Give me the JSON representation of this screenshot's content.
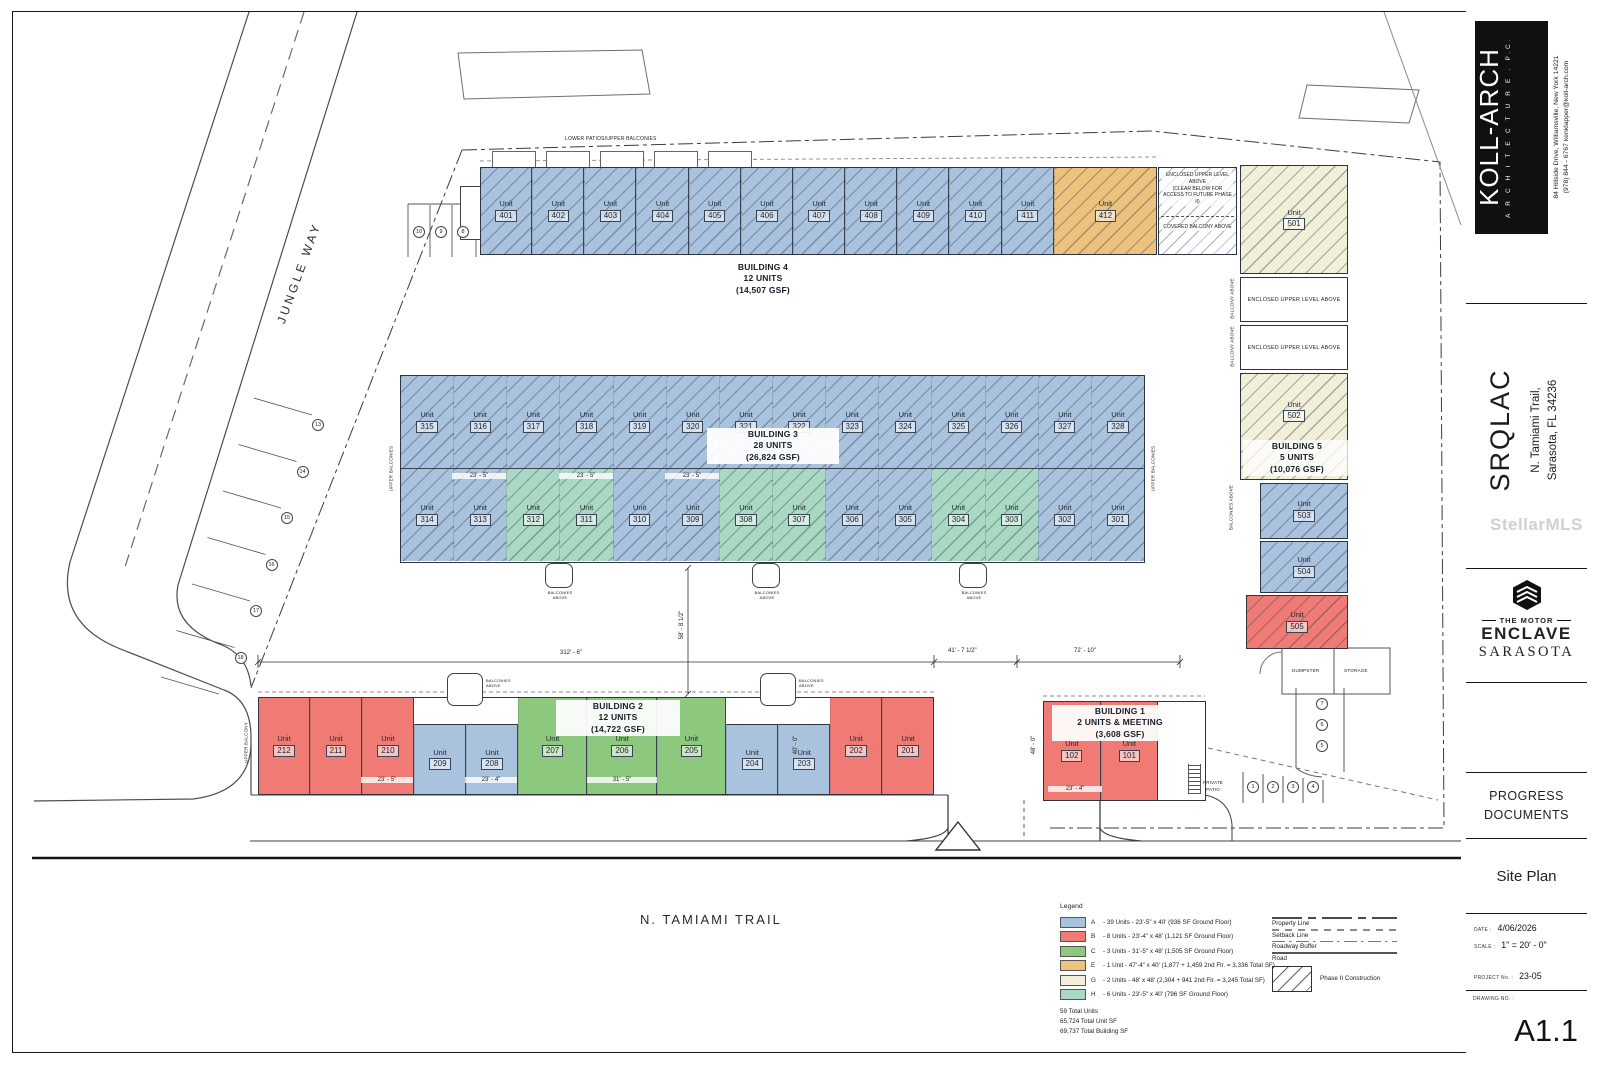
{
  "unit_label": "Unit",
  "colors": {
    "A": "#a9c2dd",
    "B": "#f07b74",
    "C": "#8cc87d",
    "E": "#edc27d",
    "G": "#f2efd9",
    "H": "#a9d8c3"
  },
  "streets": {
    "left": "JUNGLE WAY",
    "bottom": "N. TAMIAMI TRAIL"
  },
  "watermark": "StellarMLS",
  "buildings": {
    "b1": {
      "name": "BUILDING 1",
      "line2": "2 UNITS & MEETING",
      "gsf": "(3,608 GSF)",
      "units": [
        {
          "num": "102",
          "type": "B"
        },
        {
          "num": "101",
          "type": "B"
        }
      ]
    },
    "b2": {
      "name": "BUILDING 2",
      "line2": "12 UNITS",
      "gsf": "(14,722 GSF)",
      "units": [
        {
          "num": "212",
          "type": "B"
        },
        {
          "num": "211",
          "type": "B"
        },
        {
          "num": "210",
          "type": "B"
        },
        {
          "num": "209",
          "type": "A"
        },
        {
          "num": "208",
          "type": "A"
        },
        {
          "num": "207",
          "type": "C"
        },
        {
          "num": "206",
          "type": "C"
        },
        {
          "num": "205",
          "type": "C"
        },
        {
          "num": "204",
          "type": "A"
        },
        {
          "num": "203",
          "type": "A"
        },
        {
          "num": "202",
          "type": "B"
        },
        {
          "num": "201",
          "type": "B"
        }
      ]
    },
    "b3": {
      "name": "BUILDING 3",
      "line2": "28 UNITS",
      "gsf": "(26,824 GSF)",
      "top": [
        {
          "num": "315",
          "type": "A"
        },
        {
          "num": "316",
          "type": "A"
        },
        {
          "num": "317",
          "type": "A"
        },
        {
          "num": "318",
          "type": "A"
        },
        {
          "num": "319",
          "type": "A"
        },
        {
          "num": "320",
          "type": "A"
        },
        {
          "num": "321",
          "type": "A"
        },
        {
          "num": "322",
          "type": "A"
        },
        {
          "num": "323",
          "type": "A"
        },
        {
          "num": "324",
          "type": "A"
        },
        {
          "num": "325",
          "type": "A"
        },
        {
          "num": "326",
          "type": "A"
        },
        {
          "num": "327",
          "type": "A"
        },
        {
          "num": "328",
          "type": "A"
        }
      ],
      "bottom": [
        {
          "num": "314",
          "type": "A"
        },
        {
          "num": "313",
          "type": "A"
        },
        {
          "num": "312",
          "type": "H"
        },
        {
          "num": "311",
          "type": "H"
        },
        {
          "num": "310",
          "type": "A"
        },
        {
          "num": "309",
          "type": "A"
        },
        {
          "num": "308",
          "type": "H"
        },
        {
          "num": "307",
          "type": "H"
        },
        {
          "num": "306",
          "type": "A"
        },
        {
          "num": "305",
          "type": "A"
        },
        {
          "num": "304",
          "type": "H"
        },
        {
          "num": "303",
          "type": "H"
        },
        {
          "num": "302",
          "type": "A"
        },
        {
          "num": "301",
          "type": "A"
        }
      ]
    },
    "b4": {
      "name": "BUILDING 4",
      "line2": "12 UNITS",
      "gsf": "(14,507 GSF)",
      "units": [
        {
          "num": "401",
          "type": "A"
        },
        {
          "num": "402",
          "type": "A"
        },
        {
          "num": "403",
          "type": "A"
        },
        {
          "num": "404",
          "type": "A"
        },
        {
          "num": "405",
          "type": "A"
        },
        {
          "num": "406",
          "type": "A"
        },
        {
          "num": "407",
          "type": "A"
        },
        {
          "num": "408",
          "type": "A"
        },
        {
          "num": "409",
          "type": "A"
        },
        {
          "num": "410",
          "type": "A"
        },
        {
          "num": "411",
          "type": "A"
        },
        {
          "num": "412",
          "type": "E"
        }
      ]
    },
    "b5": {
      "name": "BUILDING 5",
      "line2": "5 UNITS",
      "gsf": "(10,076 GSF)",
      "units": [
        {
          "num": "501",
          "type": "G"
        },
        {
          "num": "502",
          "type": "G"
        },
        {
          "num": "503",
          "type": "A"
        },
        {
          "num": "504",
          "type": "A"
        },
        {
          "num": "505",
          "type": "B"
        }
      ]
    }
  },
  "notes": {
    "lower_patios": "LOWER PATIOS/UPPER BALCONIES",
    "enclosed_access_1": "ENCLOSED UPPER LEVEL ABOVE",
    "enclosed_access_2": "(CLEAR BELOW FOR ACCESS TO FUTURE PHASE II)",
    "covered_balcony": "COVERED BALCONY ABOVE",
    "enclosed_upper": "ENCLOSED UPPER LEVEL ABOVE",
    "balcony_above": "BALCONY ABOVE",
    "balconies_above": "BALCONIES ABOVE",
    "upper_balconies": "UPPER BALCONIES",
    "upper_balcony": "UPPER BALCONY",
    "private_patio": "PRIVATE PATIO",
    "dumpster": "DUMPSTER",
    "storage": "STORAGE"
  },
  "dims": {
    "d312": "312' - 6\"",
    "d41": "41' - 7 1/2\"",
    "d72": "72' - 10\"",
    "d23_5": "23' - 5\"",
    "d23_4": "23' - 4\"",
    "d31_5": "31' - 5\"",
    "d58": "58' - 8 1/2\"",
    "d40": "40' - 0\"",
    "d48": "48' - 0\""
  },
  "parking": {
    "left": [
      "13",
      "14",
      "15",
      "16",
      "17",
      "18"
    ],
    "top": [
      "10",
      "9",
      "8"
    ],
    "right": [
      "7",
      "6",
      "5"
    ],
    "b1": [
      "1",
      "2",
      "3",
      "4"
    ]
  },
  "legend": {
    "title": "Legend",
    "types": [
      {
        "key": "A",
        "color": "#a9c2dd",
        "desc": "- 39 Units - 23'-5\" x 40' (936 SF Ground Floor)"
      },
      {
        "key": "B",
        "color": "#f07b74",
        "desc": "- 8  Units - 23'-4\" x 48' (1,121 SF Ground Floor)"
      },
      {
        "key": "C",
        "color": "#8cc87d",
        "desc": "- 3 Units - 31'-5\" x 48' (1,505 SF Ground Floor)"
      },
      {
        "key": "E",
        "color": "#edc27d",
        "desc": "- 1 Unit - 47'-4\" x 40' (1,877 + 1,459 2nd Flr. = 3,336 Total SF)"
      },
      {
        "key": "G",
        "color": "#f2efd9",
        "desc": "- 2 Units - 48' x 48' (2,304 + 941 2nd Flr. = 3,245 Total SF)"
      },
      {
        "key": "H",
        "color": "#a9d8c3",
        "desc": "- 6 Units - 23'-5\" x 40' (796 SF Ground Floor)"
      }
    ],
    "lines": [
      {
        "label": "Property Line",
        "style": "property"
      },
      {
        "label": "Setback Line",
        "style": "setback"
      },
      {
        "label": "Roadway Buffer",
        "style": "buffer"
      },
      {
        "label": "Road",
        "style": "road"
      }
    ],
    "phase2": "Phase II Construction",
    "totals": [
      "59 Total Units",
      "65,724 Total Unit SF",
      "69,737 Total Building SF"
    ]
  },
  "title_block": {
    "firm": {
      "name": "KOLL-ARCH",
      "tagline": "A R C H I T E C T U R E . P.C.",
      "address": "84 Hillside Drive, Williamsville, New York 14221",
      "contact": "(978) 844 - 6767    kenklapper@koll-arch.com"
    },
    "project": {
      "name": "SRQLAC",
      "addr1": "N. Tamiami Trail,",
      "addr2": "Sarasota, FL 34236"
    },
    "client": {
      "line1": "THE MOTOR",
      "line2": "ENCLAVE",
      "line3": "SARASOTA"
    },
    "status_1": "PROGRESS",
    "status_2": "DOCUMENTS",
    "sheet_title": "Site Plan",
    "date_label": "DATE :",
    "date": "4/06/2026",
    "scale_label": "SCALE :",
    "scale": "1\" = 20' - 0\"",
    "project_no_label": "PROJECT No. :",
    "project_no": "23-05",
    "drawing_no_label": "DRAWING NO. :",
    "drawing_no": "A1.1"
  }
}
